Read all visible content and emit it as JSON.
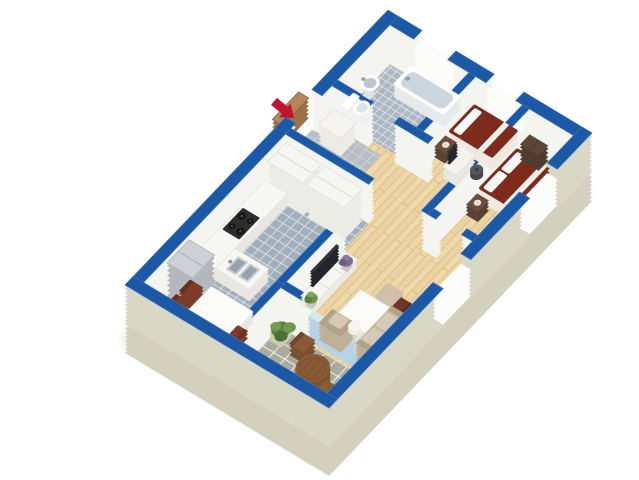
{
  "scene": {
    "type": "isometric-3d-floor-plan",
    "background": "#ffffff",
    "description": "Top-down angled 3D render of an apartment floor plan with blue wall tops, white wall faces and a beige base slab"
  },
  "colors": {
    "wall_top": "#1b58a6",
    "wall_side": "#f4f4f0",
    "wall_exterior": "#d9d7c5",
    "slab": "#d3d1bd",
    "shadow": "#c2c2bb",
    "floor_wood": "#ecd3a2",
    "tile_kitchen": "#a3afbc",
    "tile_bathroom": "#aeb8c3",
    "tile_entry": "#b7bdc4",
    "tile_balcony": "#a9ac9d",
    "bed_maroon": "#7c2b1d",
    "sofa_beige": "#c8baa1",
    "furniture_wood": "#8a5a34",
    "arrow_red": "#c1122f",
    "glass": "#b7d2e4",
    "tv_dark": "#31353b"
  },
  "entrance": {
    "marker": "red arrow pointing at open wooden entry door",
    "location": "upper-left exterior wall"
  },
  "rooms": [
    {
      "id": "bathroom",
      "floor": "blue-gray tile",
      "furniture": [
        "bathtub",
        "pedestal sink",
        "toilet"
      ]
    },
    {
      "id": "entry-hall",
      "floor": "gray tile into wood corridor",
      "furniture": [
        "white sideboard"
      ]
    },
    {
      "id": "kitchen",
      "floor": "blue-gray tile",
      "furniture": [
        "tall cabinets",
        "L-shaped counter",
        "4-burner stove",
        "double sink",
        "refrigerator"
      ]
    },
    {
      "id": "dining-area",
      "floor": "blue-gray tile",
      "furniture": [
        "white dining table",
        "3 dark red chairs"
      ]
    },
    {
      "id": "bedroom-small",
      "floor": "wood",
      "furniture": [
        "single bed with dark red cover",
        "dark nightstand with lamp",
        "desk with monitor",
        "office chair"
      ]
    },
    {
      "id": "bedroom-master",
      "floor": "wood",
      "furniture": [
        "double bed with dark red cover and two pillows",
        "dark nightstand with lamp",
        "dark dresser"
      ]
    },
    {
      "id": "living-room",
      "floor": "wood",
      "furniture": [
        "TV stand with flat TV",
        "two potted plants",
        "pouf",
        "white table",
        "dark red chair",
        "beige sofa",
        "beige armchair",
        "floor lamp"
      ]
    },
    {
      "id": "balcony",
      "floor": "stone tile",
      "furniture": [
        "round wooden table",
        "two wooden chairs",
        "two potted plants"
      ],
      "access": "sliding glass door"
    }
  ],
  "openings": {
    "windows": 4,
    "entry_door": "open wooden door",
    "balcony_door": "glass"
  }
}
